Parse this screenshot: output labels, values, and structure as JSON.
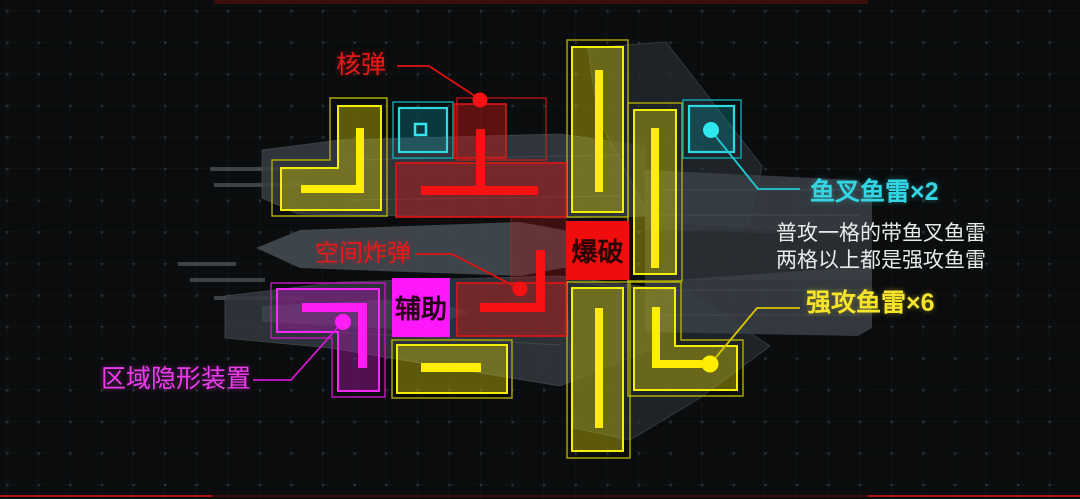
{
  "colors": {
    "red_accent": "#ee1414",
    "yellow_accent": "#ffe912",
    "cyan_accent": "#2fd8e2",
    "magenta_accent": "#ff1ef5",
    "text_white": "#e8ecec",
    "badge_auxiliary_bg": "#ff17fb",
    "badge_blast_bg": "#ef0d0d",
    "background": "#0a0c0d"
  },
  "callouts": {
    "nuke": "核弹",
    "space_bomb": "空间炸弹",
    "harpoon_torpedo": "鱼叉鱼雷×2",
    "strong_torpedo": "强攻鱼雷×6",
    "area_cloak": "区域隐形装置"
  },
  "badges": {
    "auxiliary": "辅助",
    "blast": "爆破"
  },
  "note": {
    "line1": "普攻一格的带鱼叉鱼雷",
    "line2": "两格以上都是强攻鱼雷"
  }
}
